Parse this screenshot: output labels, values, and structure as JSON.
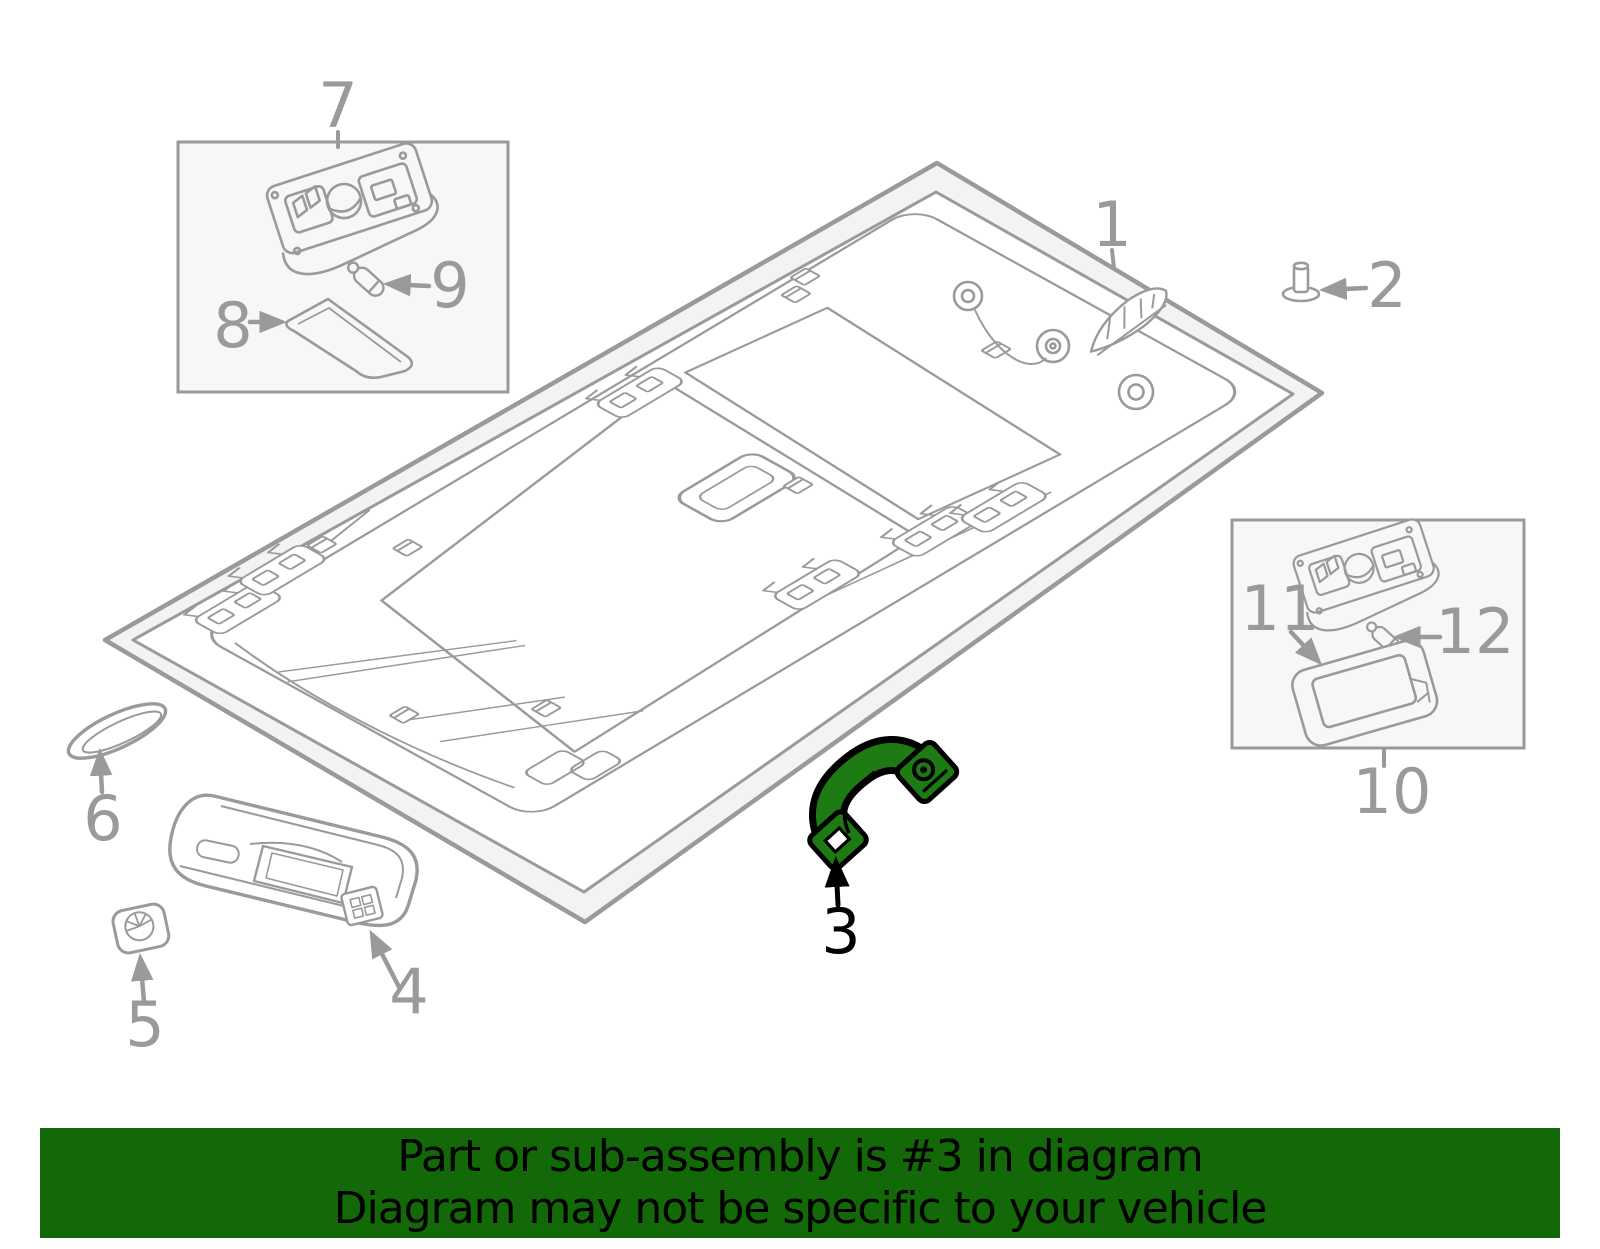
{
  "banner": {
    "line1": "Part or sub-assembly is #3 in diagram",
    "line2": "Diagram may not be specific to your vehicle",
    "background_color": "#136807",
    "text_color": "#000000"
  },
  "diagram": {
    "description": "Exploded parts diagram of a vehicle headliner and roof interior trim",
    "line_color": "#9a9a9a",
    "highlight_color": "#1e7a12",
    "highlighted_callout": "3",
    "callouts": [
      "1",
      "2",
      "3",
      "4",
      "5",
      "6",
      "7",
      "8",
      "9",
      "10",
      "11",
      "12"
    ]
  }
}
